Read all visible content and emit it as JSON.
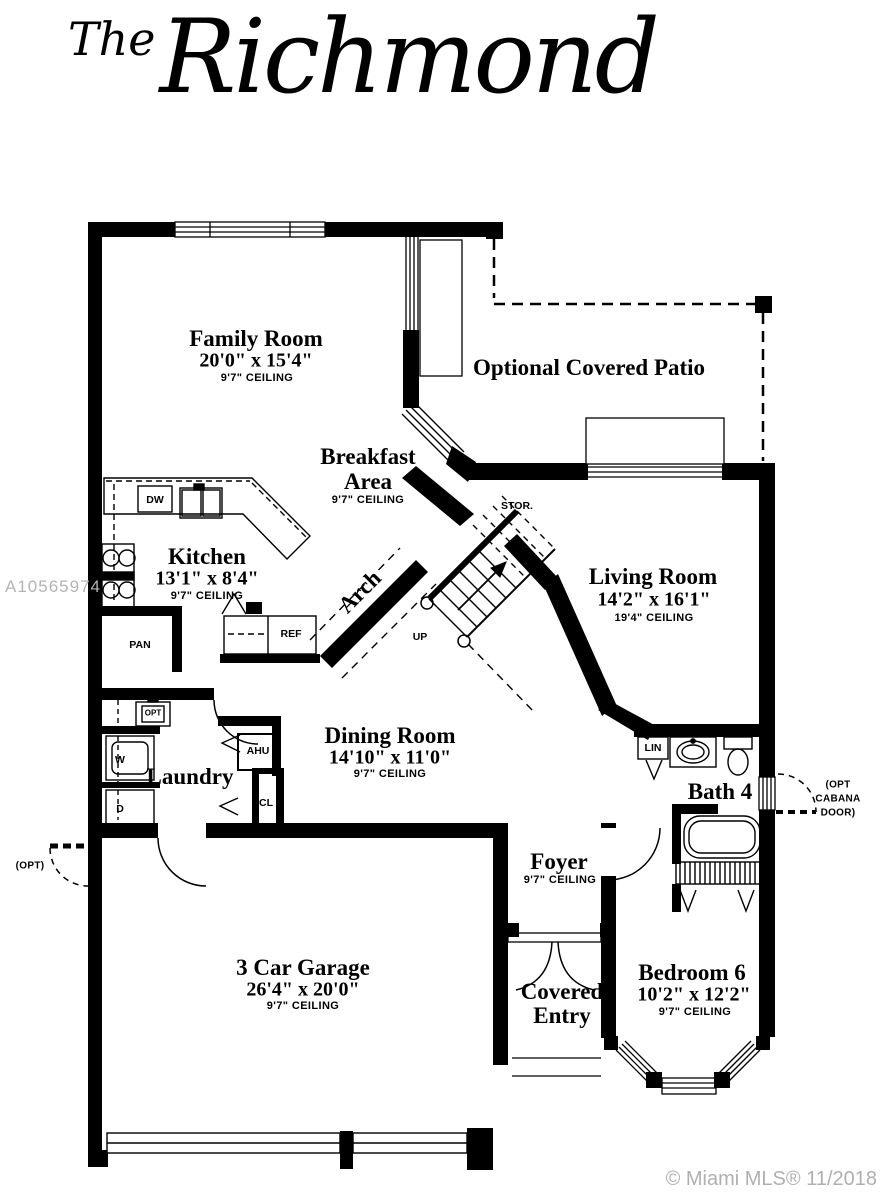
{
  "title": {
    "prefix": "The",
    "name": "Richmond"
  },
  "watermark": "A10565974",
  "copyright": "© Miami MLS® 11/2018",
  "rooms": {
    "family": {
      "name": "Family Room",
      "dims": "20'0\" x 15'4\"",
      "ceiling": "9'7\" CEILING"
    },
    "patio": {
      "name": "Optional Covered Patio"
    },
    "breakfast": {
      "line1": "Breakfast",
      "line2": "Area",
      "ceiling": "9'7\" CEILING"
    },
    "kitchen": {
      "name": "Kitchen",
      "dims": "13'1\" x 8'4\"",
      "ceiling": "9'7\" CEILING"
    },
    "living": {
      "name": "Living Room",
      "dims": "14'2\" x 16'1\"",
      "ceiling": "19'4\" CEILING"
    },
    "dining": {
      "name": "Dining Room",
      "dims": "14'10\" x 11'0\"",
      "ceiling": "9'7\" CEILING"
    },
    "laundry": {
      "name": "Laundry"
    },
    "bath4": {
      "name": "Bath 4"
    },
    "foyer": {
      "name": "Foyer",
      "ceiling": "9'7\" CEILING"
    },
    "garage": {
      "name": "3 Car Garage",
      "dims": "26'4\" x 20'0\"",
      "ceiling": "9'7\" CEILING"
    },
    "covered_entry": {
      "line1": "Covered",
      "line2": "Entry"
    },
    "bedroom6": {
      "name": "Bedroom 6",
      "dims": "10'2\" x 12'2\"",
      "ceiling": "9'7\" CEILING"
    }
  },
  "fixtures": {
    "dw": "DW",
    "pan": "PAN",
    "ref": "REF",
    "ahu": "AHU",
    "cl": "CL",
    "w": "W",
    "d": "D",
    "opt_sink": "OPT",
    "lin": "LIN",
    "stor": "STOR.",
    "up": "UP",
    "arch": "Arch"
  },
  "annotations": {
    "opt_left": "(OPT)",
    "cabana_line1": "(OPT",
    "cabana_line2": "CABANA",
    "cabana_line3": "DOOR)"
  },
  "colors": {
    "wall": "#000000",
    "watermark": "#b5b5b5",
    "copyright": "#b0b0b0"
  }
}
